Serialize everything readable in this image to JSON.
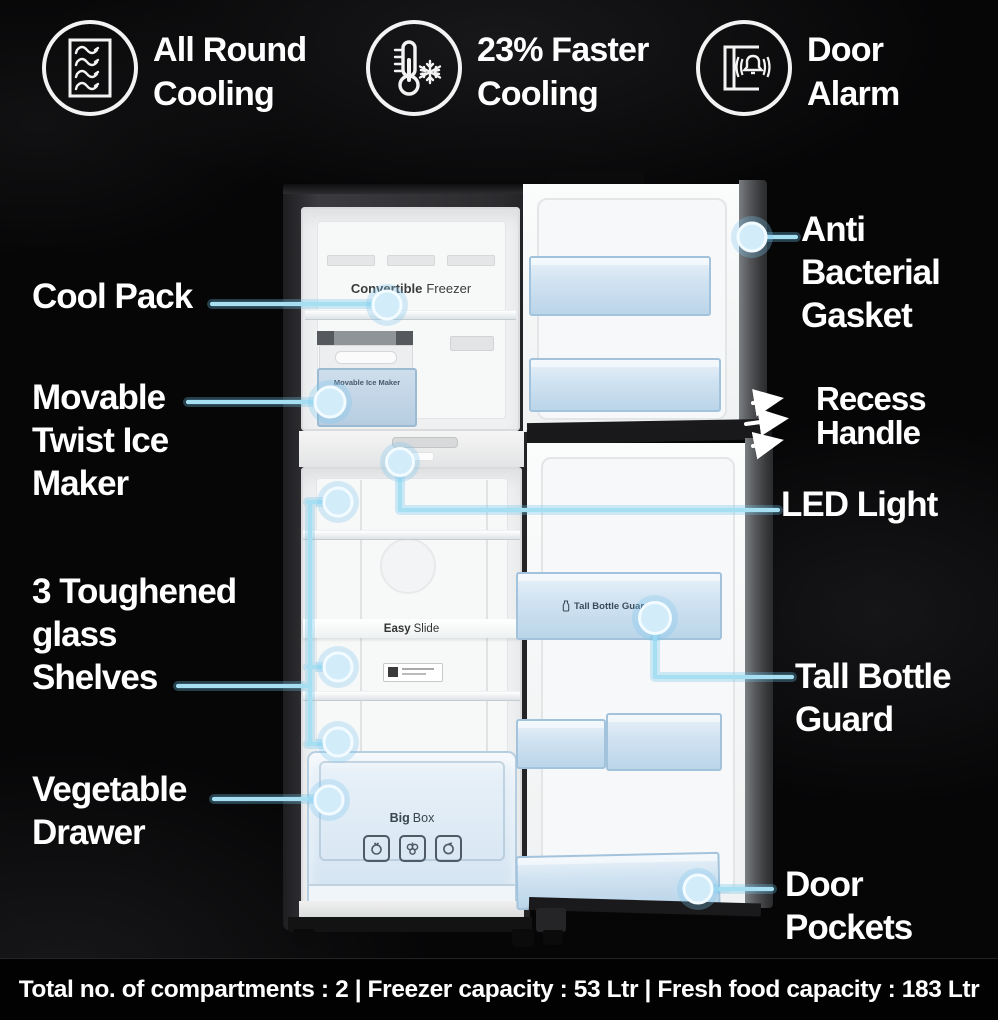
{
  "header": {
    "features": [
      {
        "icon": "airflow-grid-icon",
        "line1": "All Round",
        "line2": "Cooling"
      },
      {
        "icon": "thermometer-snowflake-icon",
        "line1": "23% Faster",
        "line2": "Cooling"
      },
      {
        "icon": "door-alarm-icon",
        "line1": "Door",
        "line2": "Alarm"
      }
    ]
  },
  "callouts": {
    "left": [
      {
        "id": "cool-pack",
        "line1": "Cool Pack"
      },
      {
        "id": "movable-twist-ice-maker",
        "line1": "Movable",
        "line2": "Twist Ice",
        "line3": "Maker"
      },
      {
        "id": "toughened-glass-shelves",
        "line1": "3 Toughened",
        "line2": "glass",
        "line3": "Shelves"
      },
      {
        "id": "vegetable-drawer",
        "line1": "Vegetable",
        "line2": "Drawer"
      }
    ],
    "right": [
      {
        "id": "anti-bacterial-gasket",
        "line1": "Anti",
        "line2": "Bacterial",
        "line3": "Gasket"
      },
      {
        "id": "recess-handle",
        "line1": "Recess",
        "line2": "Handle"
      },
      {
        "id": "led-light",
        "line1": "LED Light"
      },
      {
        "id": "tall-bottle-guard",
        "line1": "Tall Bottle",
        "line2": "Guard"
      },
      {
        "id": "door-pockets",
        "line1": "Door",
        "line2": "Pockets"
      }
    ]
  },
  "fridge_labels": {
    "convertible_bold": "Convertible",
    "convertible_rest": "Freezer",
    "ice_maker": "Movable Ice Maker",
    "easy_slide_bold": "Easy",
    "easy_slide_rest": "Slide",
    "tall_bottle_guard": "Tall Bottle Guard",
    "big_box_bold": "Big",
    "big_box_rest": "Box"
  },
  "footer": {
    "specs": "Total no. of compartments : 2 | Freezer capacity : 53 Ltr | Fresh food capacity : 183 Ltr"
  },
  "colors": {
    "accent_line": "#a6def2",
    "dot_fill": "#d3ecf9",
    "arrow": "#ffffff",
    "text": "#ffffff",
    "background": "#060607"
  }
}
